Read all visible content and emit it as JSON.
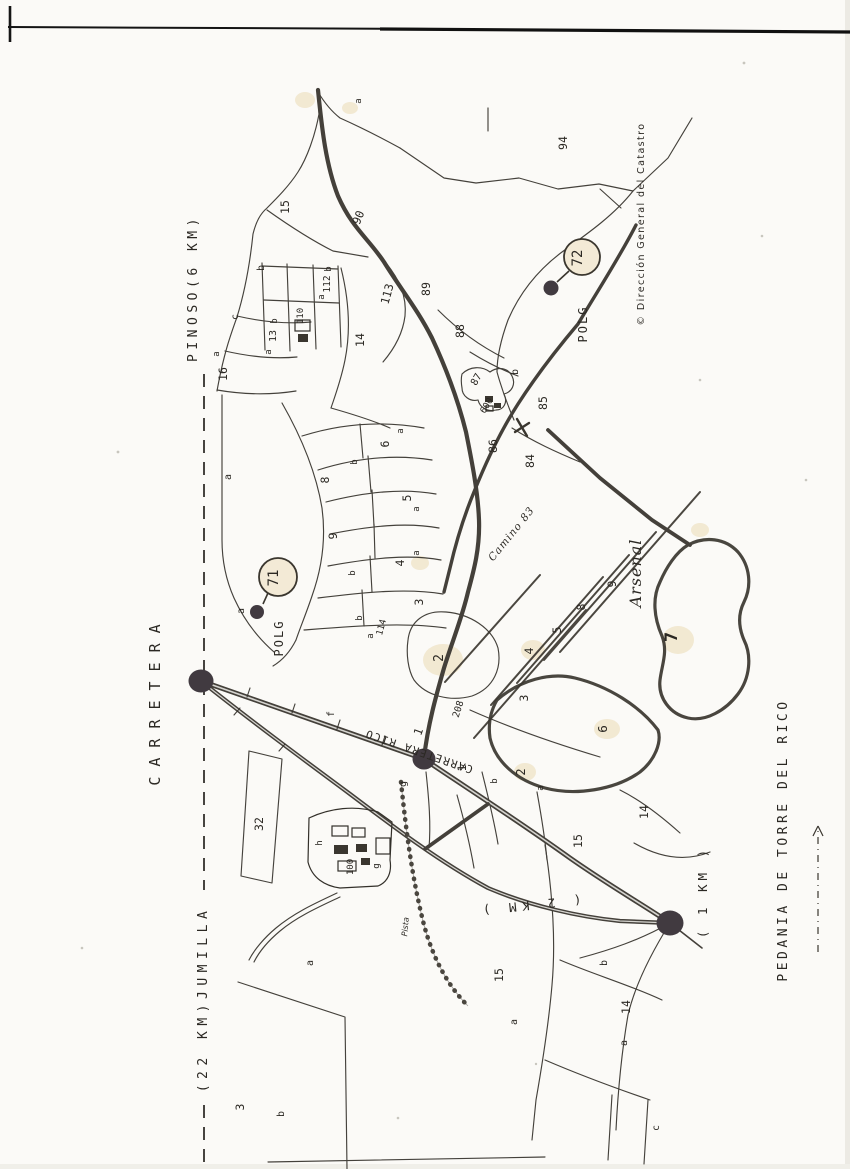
{
  "title": "Croquis catastral - Pedania de Torre del Rico (Polg 71 / Polg 72)",
  "colors": {
    "paper": "#fbfaf7",
    "ink": "#35322c",
    "road": "#44403a",
    "stain": "#e9d7ae",
    "marker_fill": "#f3ead6",
    "dot": "#413a40"
  },
  "margin_labels": [
    {
      "name": "label-carretera",
      "text": "CARRETERA",
      "x": 160,
      "y": 700,
      "rot": -90,
      "size": 15,
      "ls": 10,
      "font": "mono"
    },
    {
      "name": "label-pinoso",
      "text": "PINOSO(6 KM)",
      "x": 197,
      "y": 288,
      "rot": -90,
      "size": 13,
      "ls": 4.5,
      "font": "mono"
    },
    {
      "name": "label-jumilla",
      "text": "(22 KM)JUMILLA",
      "x": 207,
      "y": 999,
      "rot": -90,
      "size": 13,
      "ls": 5.5,
      "font": "mono"
    },
    {
      "name": "label-pedania",
      "text": "PEDANIA DE TORRE DEL RICO",
      "x": 787,
      "y": 840,
      "rot": -90,
      "size": 13,
      "ls": 3.5,
      "font": "mono"
    },
    {
      "name": "label-1km",
      "text": "( 1 KM )",
      "x": 707,
      "y": 892,
      "rot": -90,
      "size": 12.5,
      "ls": 4,
      "font": "mono"
    },
    {
      "name": "label-2km",
      "text": "( 2 KM )",
      "x": 529,
      "y": 901,
      "rot": 174,
      "size": 12.5,
      "ls": 5.5,
      "font": "mono"
    },
    {
      "name": "label-copyright",
      "text": "© Dirección General del Catastro",
      "x": 644,
      "y": 224,
      "rot": -90,
      "size": 9.5,
      "ls": 1.4,
      "font": "sans"
    }
  ],
  "road_labels": [
    {
      "name": "label-carretera-rico",
      "text": "CARRETERA  RICO",
      "x": 420,
      "y": 748,
      "rot": -161,
      "size": 11,
      "ls": 1.5,
      "font": "mono"
    },
    {
      "name": "label-camino-83",
      "text": "Camino  83",
      "x": 514,
      "y": 536,
      "rot": -51,
      "size": 10.5,
      "ls": 1,
      "font": "serif",
      "italic": true
    },
    {
      "name": "label-arsenal",
      "text": "Arsenal",
      "x": 641,
      "y": 573,
      "rot": -90,
      "size": 16,
      "ls": 1,
      "font": "serif",
      "italic": true
    },
    {
      "name": "label-pista",
      "text": "Pista",
      "x": 408,
      "y": 927,
      "rot": -85,
      "size": 8,
      "ls": 0,
      "font": "sans",
      "italic": true
    }
  ],
  "polygon_markers": [
    {
      "name": "polg-71-marker",
      "label": "POLG",
      "number": "71",
      "cx": 278,
      "cy": 577,
      "r": 19,
      "label_x": 283,
      "label_y": 638,
      "dot_x": 257,
      "dot_y": 612,
      "dot_r": 7,
      "lx1": 263,
      "ly1": 604,
      "lx2": 268,
      "ly2": 593,
      "sub": "a",
      "sub_x": 244,
      "sub_y": 611
    },
    {
      "name": "polg-72-marker",
      "label": "POLG",
      "number": "72",
      "cx": 582,
      "cy": 257,
      "r": 18,
      "label_x": 587,
      "label_y": 324,
      "dot_x": 551,
      "dot_y": 288,
      "dot_r": 7.5,
      "lx1": 557,
      "ly1": 282,
      "lx2": 569,
      "ly2": 271
    }
  ],
  "parcel_labels": [
    {
      "t": "15",
      "x": 289,
      "y": 207
    },
    {
      "t": "b",
      "x": 264,
      "y": 268,
      "s": 10
    },
    {
      "t": "c",
      "x": 238,
      "y": 317,
      "s": 10
    },
    {
      "t": "a",
      "x": 219,
      "y": 354,
      "s": 9
    },
    {
      "t": "16",
      "x": 227,
      "y": 374
    },
    {
      "t": "a",
      "x": 361,
      "y": 101,
      "s": 9
    },
    {
      "t": "a",
      "x": 271,
      "y": 352,
      "s": 9
    },
    {
      "t": "13",
      "x": 276,
      "y": 336,
      "s": 10
    },
    {
      "t": "b",
      "x": 277,
      "y": 321,
      "s": 9
    },
    {
      "t": "110",
      "x": 303,
      "y": 316,
      "s": 9
    },
    {
      "t": "a",
      "x": 324,
      "y": 297,
      "s": 9
    },
    {
      "t": "112",
      "x": 330,
      "y": 284,
      "s": 9.5
    },
    {
      "t": "b",
      "x": 331,
      "y": 269,
      "s": 9
    },
    {
      "t": "14",
      "x": 364,
      "y": 340
    },
    {
      "t": "90",
      "x": 362,
      "y": 219,
      "r": -68
    },
    {
      "t": "113",
      "x": 391,
      "y": 295,
      "r": -75
    },
    {
      "t": "89",
      "x": 430,
      "y": 289
    },
    {
      "t": "88",
      "x": 464,
      "y": 331
    },
    {
      "t": "87",
      "x": 479,
      "y": 381,
      "s": 10,
      "r": -60
    },
    {
      "t": "600",
      "x": 489,
      "y": 407,
      "s": 9,
      "r": -60
    },
    {
      "t": "b",
      "x": 518,
      "y": 372,
      "s": 10
    },
    {
      "t": "86",
      "x": 497,
      "y": 446
    },
    {
      "t": "85",
      "x": 547,
      "y": 403
    },
    {
      "t": "84",
      "x": 534,
      "y": 461
    },
    {
      "t": "94",
      "x": 567,
      "y": 143
    },
    {
      "t": "a",
      "x": 231,
      "y": 477,
      "s": 10
    },
    {
      "t": "8",
      "x": 329,
      "y": 480
    },
    {
      "t": "b",
      "x": 357,
      "y": 462,
      "s": 9
    },
    {
      "t": "6",
      "x": 389,
      "y": 444
    },
    {
      "t": "a",
      "x": 403,
      "y": 431,
      "s": 9
    },
    {
      "t": "5",
      "x": 411,
      "y": 498
    },
    {
      "t": "a",
      "x": 419,
      "y": 509,
      "s": 9
    },
    {
      "t": "9",
      "x": 337,
      "y": 536
    },
    {
      "t": "b",
      "x": 355,
      "y": 573,
      "s": 9
    },
    {
      "t": "4",
      "x": 404,
      "y": 563
    },
    {
      "t": "a",
      "x": 419,
      "y": 553,
      "s": 9
    },
    {
      "t": "b",
      "x": 362,
      "y": 618,
      "s": 9
    },
    {
      "t": "114",
      "x": 384,
      "y": 628,
      "s": 9,
      "r": -75
    },
    {
      "t": "a",
      "x": 373,
      "y": 636,
      "s": 9
    },
    {
      "t": "3",
      "x": 423,
      "y": 602
    },
    {
      "t": "2",
      "x": 443,
      "y": 658,
      "s": 13
    },
    {
      "t": "208",
      "x": 461,
      "y": 710,
      "s": 9.5,
      "r": -72
    },
    {
      "t": "9",
      "x": 616,
      "y": 584
    },
    {
      "t": "8",
      "x": 585,
      "y": 607
    },
    {
      "t": "5",
      "x": 561,
      "y": 630
    },
    {
      "t": "4",
      "x": 533,
      "y": 651
    },
    {
      "t": "3",
      "x": 528,
      "y": 698
    },
    {
      "t": "6",
      "x": 607,
      "y": 729,
      "s": 12.5
    },
    {
      "t": "7",
      "x": 677,
      "y": 637,
      "s": 17,
      "w": "bold"
    },
    {
      "t": "2",
      "x": 525,
      "y": 772,
      "s": 12
    },
    {
      "t": "b",
      "x": 497,
      "y": 781,
      "s": 9
    },
    {
      "t": "a",
      "x": 543,
      "y": 788,
      "s": 9
    },
    {
      "t": "1",
      "x": 466,
      "y": 768
    },
    {
      "t": "1",
      "x": 422,
      "y": 733,
      "r": -70
    },
    {
      "t": "f",
      "x": 334,
      "y": 714,
      "s": 10
    },
    {
      "t": "g",
      "x": 406,
      "y": 784,
      "s": 10
    },
    {
      "t": "32",
      "x": 263,
      "y": 824
    },
    {
      "t": "h",
      "x": 322,
      "y": 843,
      "s": 9
    },
    {
      "t": "100",
      "x": 353,
      "y": 867,
      "s": 9
    },
    {
      "t": "g",
      "x": 379,
      "y": 866,
      "s": 9
    },
    {
      "t": "a",
      "x": 313,
      "y": 963,
      "s": 10
    },
    {
      "t": "3",
      "x": 244,
      "y": 1107
    },
    {
      "t": "b",
      "x": 284,
      "y": 1114,
      "s": 10
    },
    {
      "t": "15",
      "x": 503,
      "y": 975
    },
    {
      "t": "a",
      "x": 517,
      "y": 1022,
      "s": 10
    },
    {
      "t": "15",
      "x": 582,
      "y": 841
    },
    {
      "t": "b",
      "x": 607,
      "y": 963,
      "s": 10
    },
    {
      "t": "14",
      "x": 630,
      "y": 1007
    },
    {
      "t": "a",
      "x": 627,
      "y": 1043,
      "s": 10
    },
    {
      "t": "c",
      "x": 659,
      "y": 1128,
      "s": 10
    },
    {
      "t": "14",
      "x": 648,
      "y": 812
    }
  ]
}
